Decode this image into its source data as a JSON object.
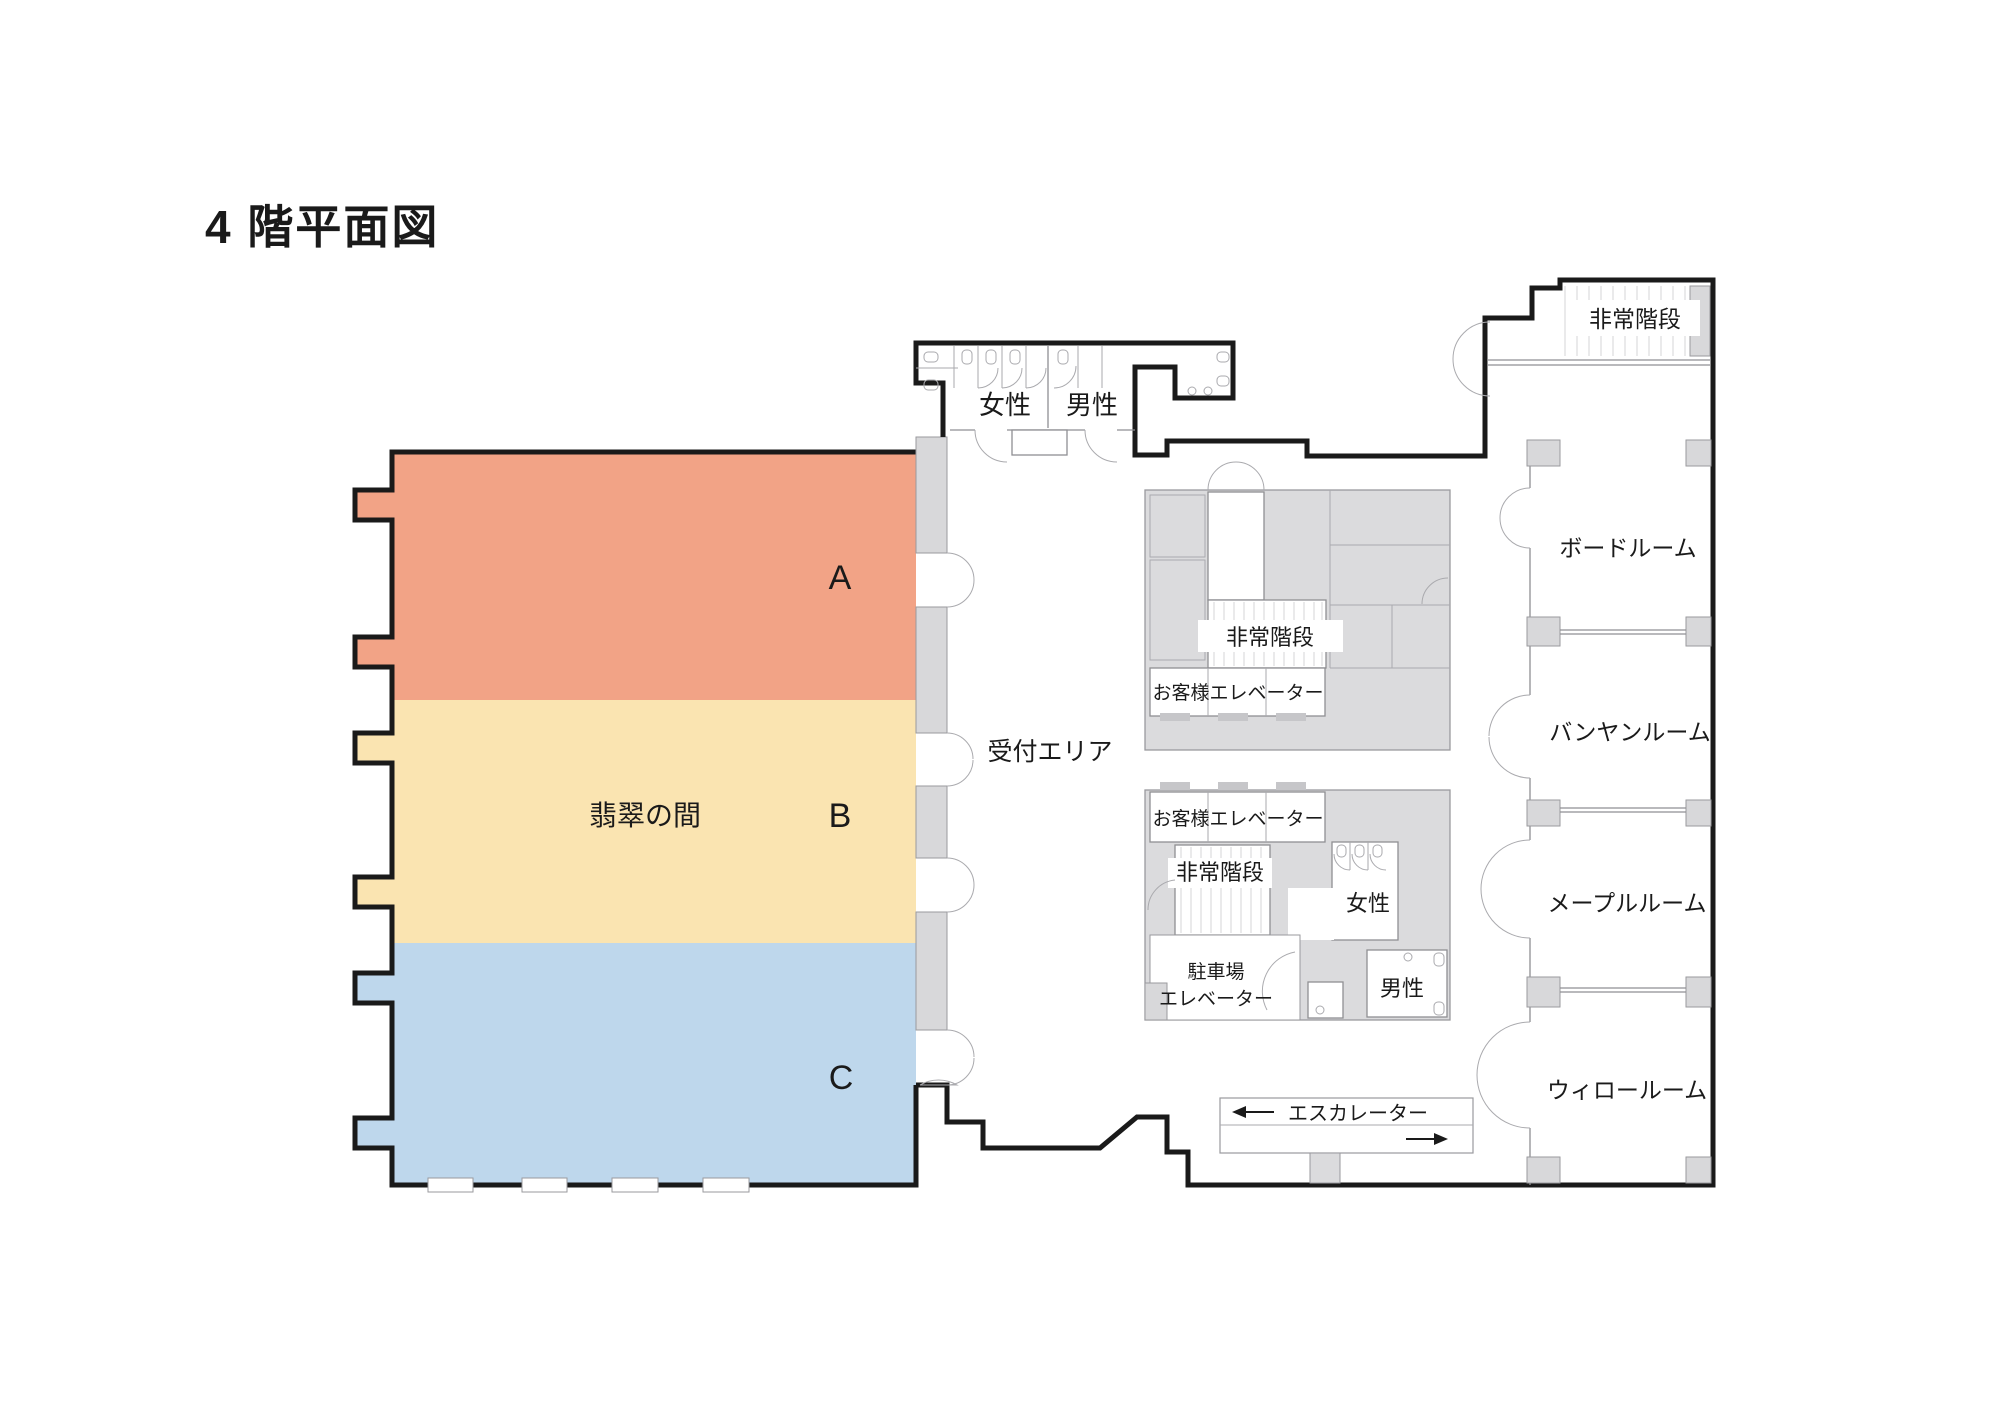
{
  "title": "4 階平面図",
  "hall": {
    "name": "翡翠の間",
    "sections": [
      {
        "label": "A",
        "color": "#F2A386"
      },
      {
        "label": "B",
        "color": "#FAE4B1"
      },
      {
        "label": "C",
        "color": "#BED7EC"
      }
    ]
  },
  "labels": {
    "reception": "受付エリア",
    "women": "女性",
    "men": "男性",
    "emergency_stairs": "非常階段",
    "guest_elevator": "お客様エレベーター",
    "parking_elevator_line1": "駐車場",
    "parking_elevator_line2": "エレベーター",
    "escalator": "エスカレーター"
  },
  "right_wing_rooms": [
    {
      "name": "ボードルーム"
    },
    {
      "name": "バンヤンルーム"
    },
    {
      "name": "メープルルーム"
    },
    {
      "name": "ウィロールーム"
    }
  ],
  "colors": {
    "wall": "#1A1A1A",
    "block_gray": "#DBDBDD",
    "pillar_gray": "#D8D8DA"
  }
}
